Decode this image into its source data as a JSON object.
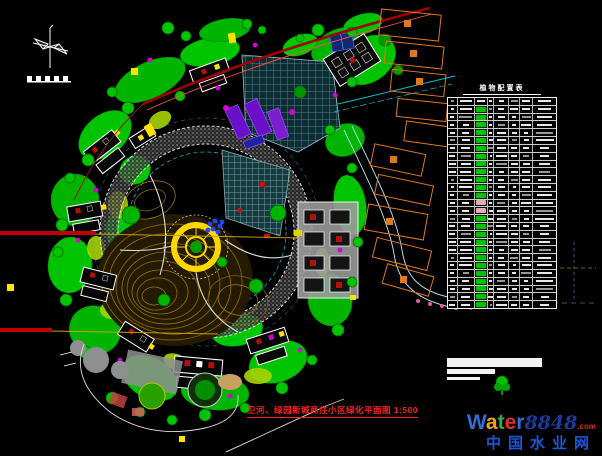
{
  "drawing": {
    "title": "卫河、绿园新城商住小区绿化平面图 1:500",
    "title_color": "#ff2020"
  },
  "legend": {
    "title": "植物配置表",
    "row_count": 27,
    "columns": 8,
    "symbol_column": 2,
    "pink_rows": [
      13,
      14
    ],
    "symbol_color": "#00c000",
    "pink_color": "#e8a8b8"
  },
  "watermark": {
    "brand_letters": [
      {
        "ch": "W",
        "color": "#2e6fd6"
      },
      {
        "ch": "a",
        "color": "#f0a01c"
      },
      {
        "ch": "t",
        "color": "#30b040"
      },
      {
        "ch": "e",
        "color": "#e03028"
      },
      {
        "ch": "r",
        "color": "#2e6fd6"
      }
    ],
    "number": "8848",
    "number_color": "#1a3a9c",
    "tld": ".com",
    "tld_color": "#d02818",
    "subtitle": "中国水业网",
    "subtitle_color": "#1858d8"
  },
  "colors": {
    "background": "#000000",
    "vegetation_green": "#00c400",
    "contour_brown": "#8a6a00",
    "boundary_red": "#a00000",
    "road_cyan": "#00c8d8",
    "plaza_yellow": "#ffd700",
    "existing_building_orange": "#e07820",
    "building_purple": "#6a10c8",
    "shrub_magenta": "#d400d4"
  }
}
